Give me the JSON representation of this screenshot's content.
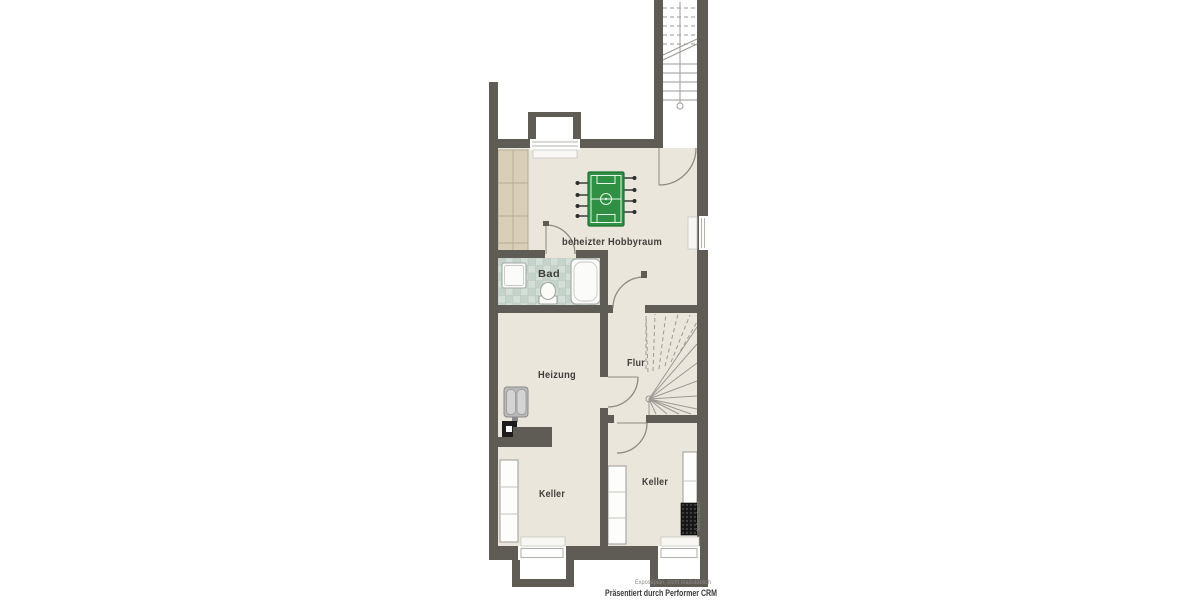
{
  "rooms": {
    "hobby": {
      "label": "beheizter Hobbyraum"
    },
    "bad": {
      "label": "Bad"
    },
    "heizung": {
      "label": "Heizung"
    },
    "flur": {
      "label": "Flur"
    },
    "keller_left": {
      "label": "Keller"
    },
    "keller_right": {
      "label": "Keller"
    }
  },
  "footer": {
    "disclaimer": "Exposéplan, nicht maßstäblich",
    "credit": "Präsentiert durch Performer CRM"
  },
  "annotations": {
    "side_caption": "Kellerschacht"
  },
  "fixtures": {
    "foosball_table": "foosball-table",
    "bathtub": "bathtub",
    "shower": "shower-tray",
    "toilet": "toilet",
    "boiler": "heating-boiler",
    "chimney": "chimney-block",
    "wine_rack": "wine-rack",
    "cabinet": "built-in-cabinet",
    "shelves": "storage-shelf",
    "staircase_upper": "staircase-to-ground-floor",
    "staircase_winder": "winder-staircase",
    "lightwell": "basement-light-well"
  },
  "colors": {
    "wall": "#5f5b55",
    "floor": "#eae6dc",
    "tile": "#d3dfd8",
    "tile_dark": "#c6d3cb",
    "tile_line": "#b7c8bf",
    "green": "#2f9044",
    "green_dark": "#1f6f33",
    "fixture_stroke": "#a3a8a4",
    "line": "#9a9a94",
    "label": "#3f3e3b",
    "muted": "#8b8b86",
    "cabinet": "#d9cfb8",
    "cabinet_line": "#b6ab90"
  }
}
